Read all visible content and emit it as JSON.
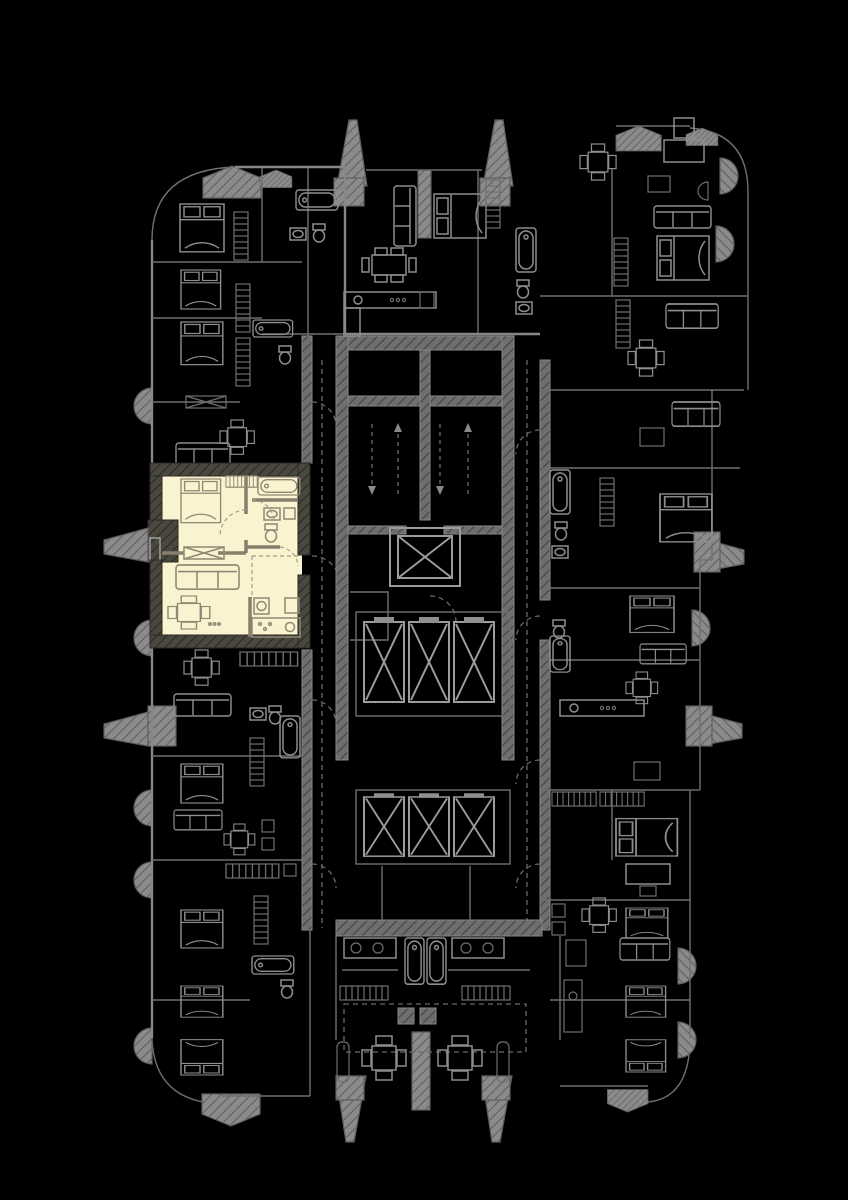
{
  "app": {
    "name": "residential-tower-floor-plan",
    "description": "Black-background architectural floor plan of a tower storey; gray line-art apartments around a central elevator and stair core; one one-bedroom apartment on the left side highlighted in cream as the selected unit. No text labels are rendered."
  },
  "palette": {
    "bg": "#000000",
    "wall_line": "#878787",
    "wall_thin": "#6f6f6f",
    "furniture_line": "#8e8e8e",
    "dash_line": "#6a6a6a",
    "hatch_bg": "#6e6e6e",
    "hatch_stroke": "#454545",
    "balcony_bg": "#8b8b8b",
    "balcony_stroke": "#5f5f5f",
    "elevator_line": "#9c9c9c",
    "highlight_fill": "#FAF3CF",
    "highlight_wall_bg": "#4a473f",
    "highlight_wall_stroke": "#2b2925",
    "highlight_partition": "#867f6c",
    "highlight_furniture": "#8f8874",
    "highlight_dash": "#a49d8a"
  },
  "floorplan": {
    "selected_unit": {
      "state": "highlighted",
      "fill": "#FAF3CF",
      "rooms": [
        "bedroom",
        "bathroom",
        "wc",
        "hall",
        "living-room",
        "kitchen"
      ],
      "furniture": [
        "double-bed",
        "wardrobe",
        "bathtub",
        "washbasin",
        "toilet",
        "sofa",
        "table-with-chairs",
        "kitchen-counter",
        "fridge",
        "window"
      ]
    },
    "core": {
      "stairwells": 2,
      "stair_direction_arrows": 4,
      "upper_elevator_bank_cars": 3,
      "lower_elevator_bank_cars": 3,
      "service_shaft_with_cross": 1
    },
    "perimeter": {
      "apartment_columns": [
        "left",
        "top",
        "right",
        "bottom"
      ],
      "balcony_fins": 8,
      "half_round_balconies": 9,
      "gabled_bay_caps": 6
    }
  }
}
